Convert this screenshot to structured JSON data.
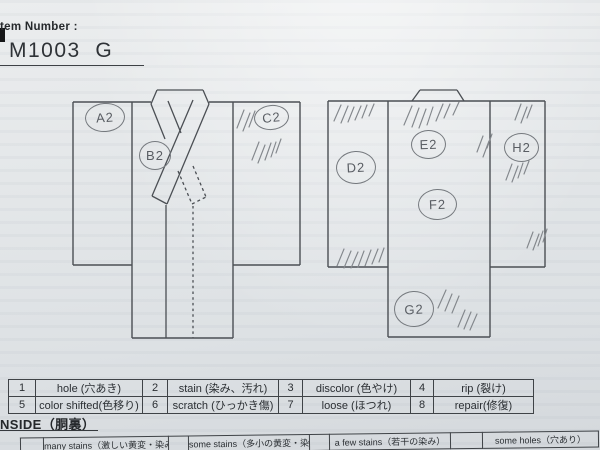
{
  "colors": {
    "paper": "#e2e5e8",
    "print_ink": "#3c4045",
    "pencil": "#75797e",
    "table_border": "#3f4347"
  },
  "header": {
    "item_label": "tem Number :",
    "item_number": "M1003  G"
  },
  "marks": {
    "front": [
      {
        "label": "A2"
      },
      {
        "label": "B2"
      },
      {
        "label": "C2"
      }
    ],
    "back": [
      {
        "label": "D2"
      },
      {
        "label": "E2"
      },
      {
        "label": "F2"
      },
      {
        "label": "G2"
      },
      {
        "label": "H2"
      }
    ]
  },
  "legend": {
    "rows": [
      [
        "1",
        "hole (穴あき)",
        "2",
        "stain (染み、汚れ)",
        "3",
        "discolor (色やけ)",
        "4",
        "rip (裂け)"
      ],
      [
        "5",
        "color shifted(色移り)",
        "6",
        "scratch (ひっかき傷)",
        "7",
        "loose (ほつれ)",
        "8",
        "repair(修復)"
      ]
    ]
  },
  "inside": {
    "title": "NSIDE（胴裏）",
    "cells": [
      "",
      "many stains（激しい黄変・染み）",
      "",
      "some stains（多小の黄変・染み）",
      "",
      "a few stains（若干の染み）",
      "",
      "some holes（穴あり）"
    ]
  }
}
